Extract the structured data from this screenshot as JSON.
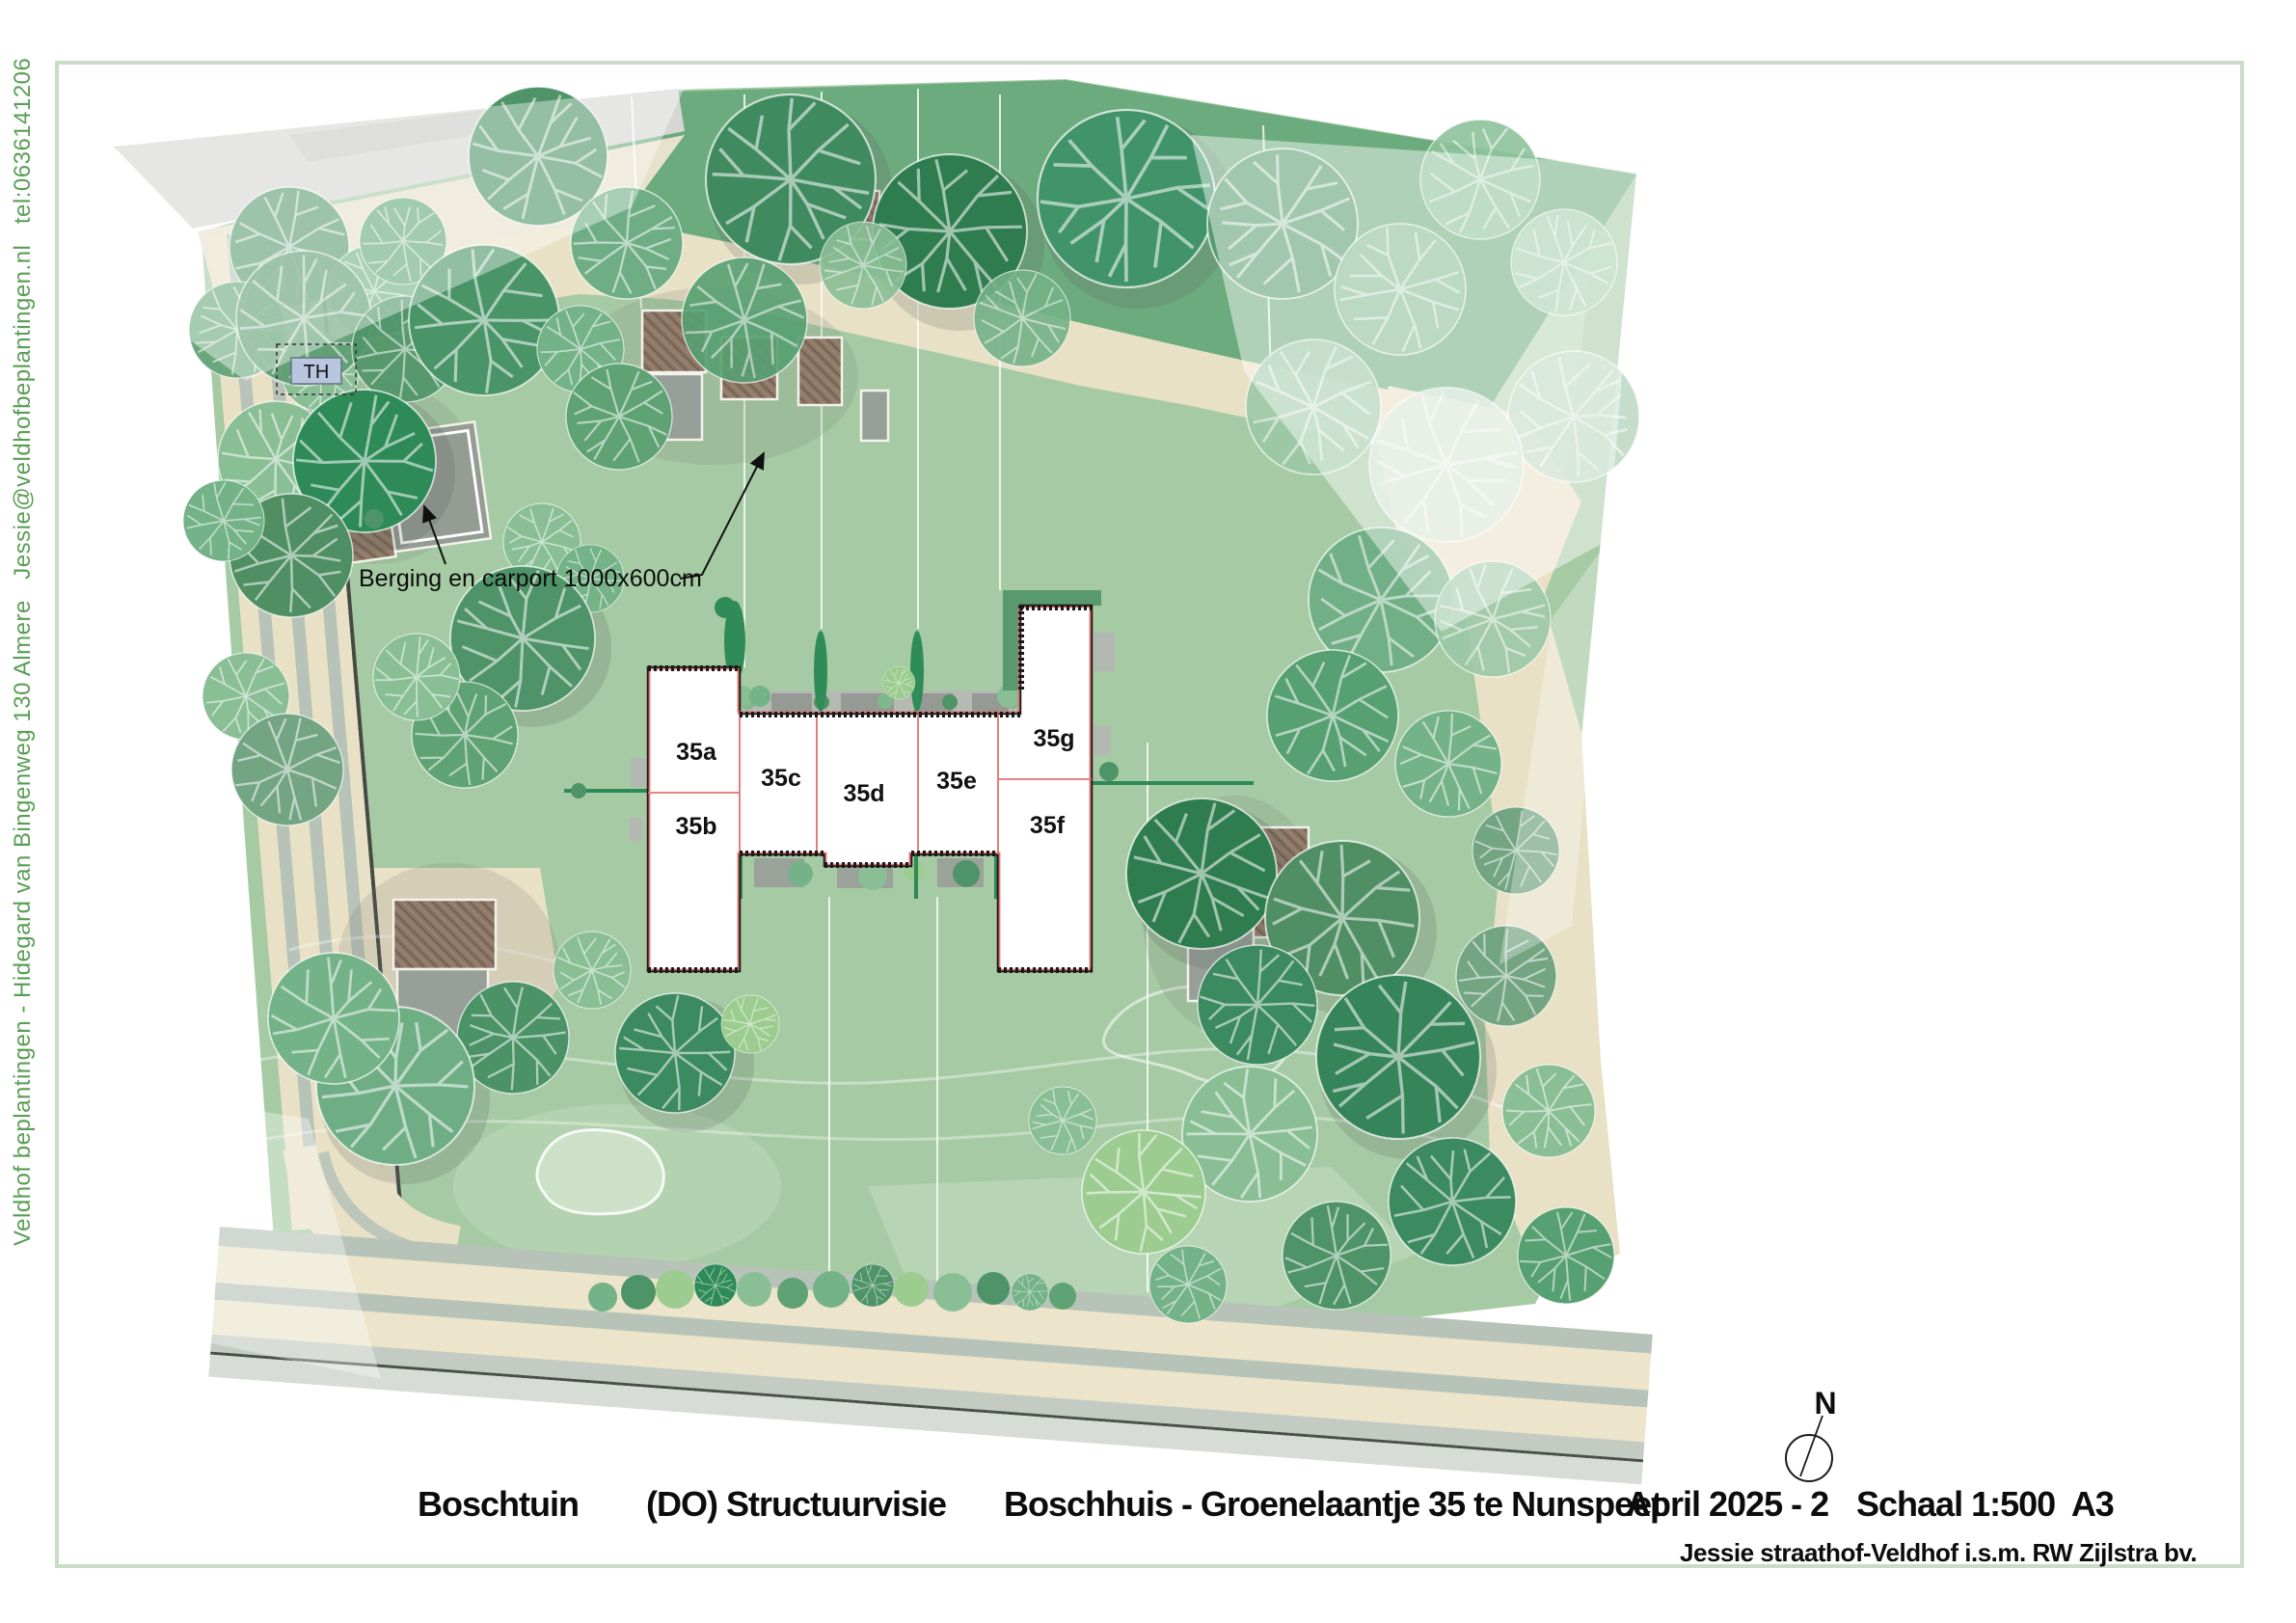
{
  "sidebar": {
    "vertical_credit": "Veldhof beplantingen - Hidegard van Bingenweg 130 Almere   Jessie@veldhofbeplantingen.nl   tel:0636141206"
  },
  "plan": {
    "th_label": "TH",
    "berging_annotation": "Berging en carport 1000x600cm",
    "compass_label": "N",
    "units": [
      "35a",
      "35b",
      "35c",
      "35d",
      "35e",
      "35f",
      "35g"
    ]
  },
  "footer": {
    "project_name": "Boschtuin",
    "document_type": "(DO) Structuurvisie",
    "project_location": "Boschhuis - Groenelaantje 35 te Nunspeet",
    "date_version": "April 2025 - 2",
    "scale_format": "Schaal 1:500  A3",
    "designer_credit": "Jessie straathof-Veldhof i.s.m. RW Zijlstra bv."
  },
  "colors": {
    "frame": "#c9dcc5",
    "grass": "#a6cba4",
    "grass_dark_band": "#6cab7e",
    "path_beige": "#e9e1c6",
    "road_stripe": "#b7c3b8",
    "shed_brown": "#8d7867",
    "carport_gray": "#949c94",
    "house_fill": "#ffffff",
    "house_line_red": "#e2726e",
    "sidebar_text": "#5a9e55",
    "th_box_blue": "#b9c6e0"
  }
}
